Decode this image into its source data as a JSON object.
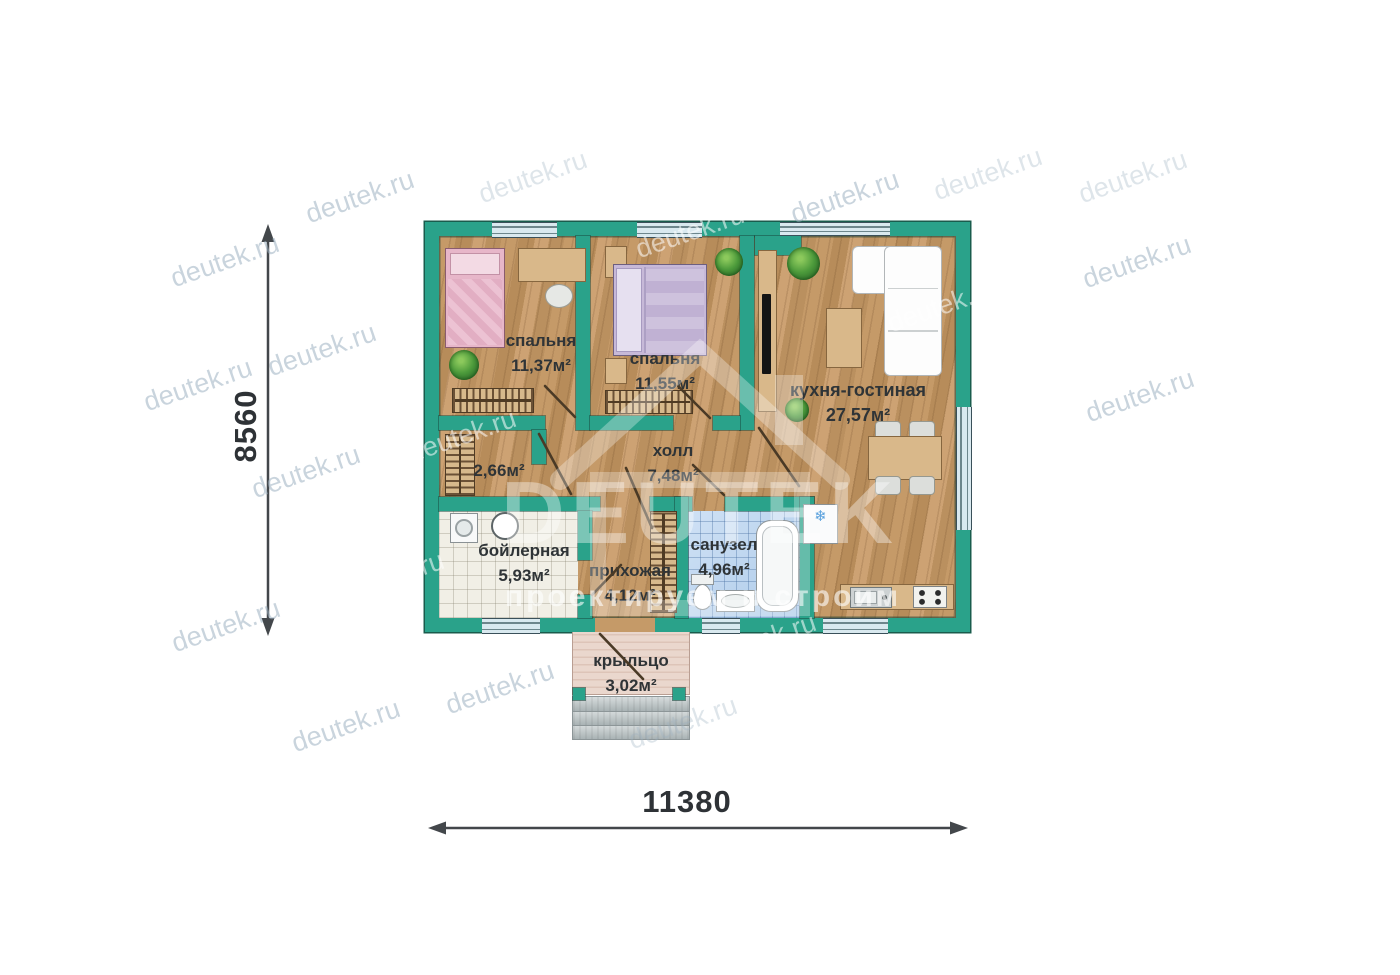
{
  "watermark": {
    "text": "deutek.ru",
    "logo_title": "DEUTEK",
    "logo_subtitle": "проектируем и строим"
  },
  "dimensions": {
    "height_mm": "8560",
    "width_mm": "11380"
  },
  "rooms": {
    "bedroom1": {
      "name": "спальня",
      "area": "11,37м²"
    },
    "bedroom2": {
      "name": "спальня",
      "area": "11,55м²"
    },
    "kitchen_living": {
      "name": "кухня-гостиная",
      "area": "27,57м²"
    },
    "hall": {
      "name": "холл",
      "area": "7,48м²"
    },
    "closet": {
      "area": "2,66м²"
    },
    "boiler": {
      "name": "бойлерная",
      "area": "5,93м²"
    },
    "entry": {
      "name": "прихожая",
      "area": "4,12м²"
    },
    "bathroom": {
      "name": "санузел",
      "area": "4,96м²"
    },
    "porch": {
      "name": "крыльцо",
      "area": "3,02м²"
    }
  },
  "colors": {
    "wall": "#2aa28a",
    "floor_wood": "#bf9463",
    "bathroom_tile": "#b9d6f0",
    "boiler_tile": "#f1efe6",
    "window_glass": "#d9e9ef",
    "bed_pink": "#e7b6c9",
    "bed_lavender": "#c7b9d8",
    "furniture_wood": "#d9b88a",
    "dimension_text": "#2e3236",
    "watermark_gray": "#9eb2c2"
  }
}
